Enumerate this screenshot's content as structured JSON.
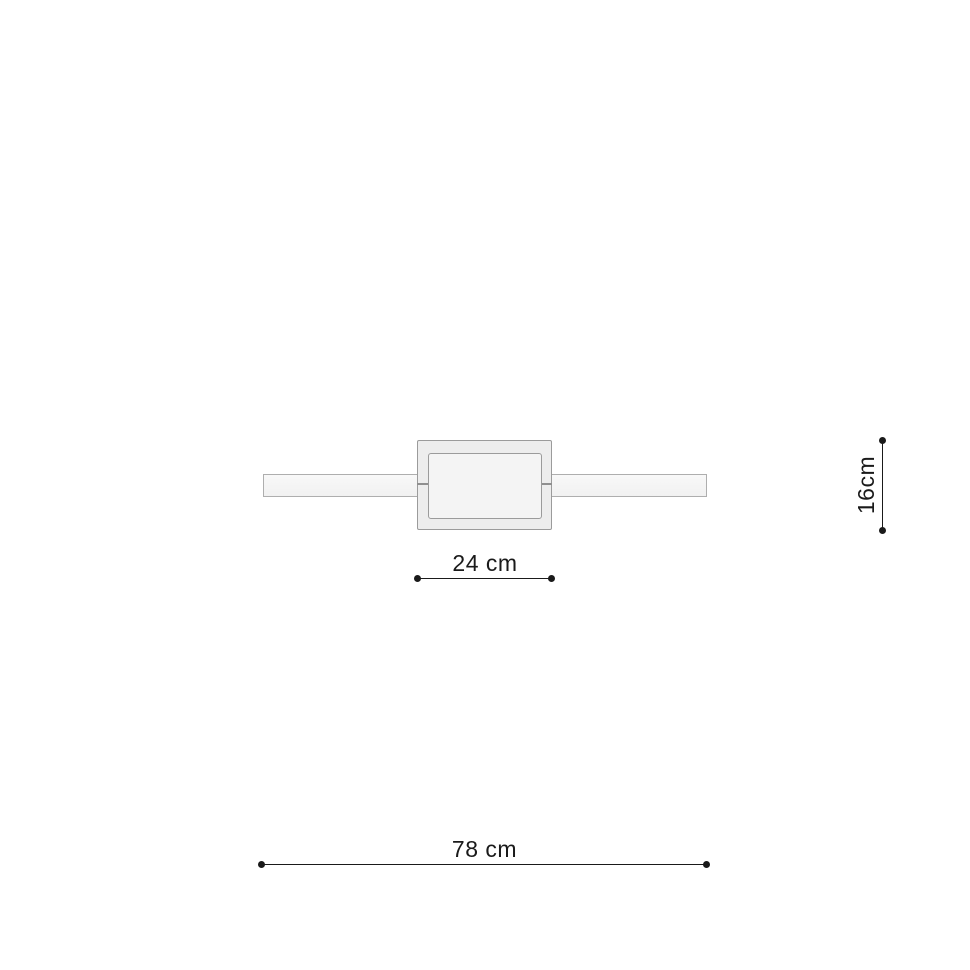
{
  "colors": {
    "background": "#ffffff",
    "bar-fill": "#f5f5f5",
    "bar-border": "#aeaeae",
    "canopy-fill": "#ededed",
    "canopy-border": "#9b9b9b",
    "panel-fill": "#f4f4f4",
    "panel-border": "#9b9b9b",
    "seam": "#8f8f8f",
    "dim-line": "#1a1a1a",
    "dim-text": "#1a1a1a"
  },
  "dimensions": {
    "canopy_width": {
      "label": "24 cm"
    },
    "fixture_height": {
      "label": "16cm"
    },
    "total_width": {
      "label": "78 cm"
    }
  }
}
